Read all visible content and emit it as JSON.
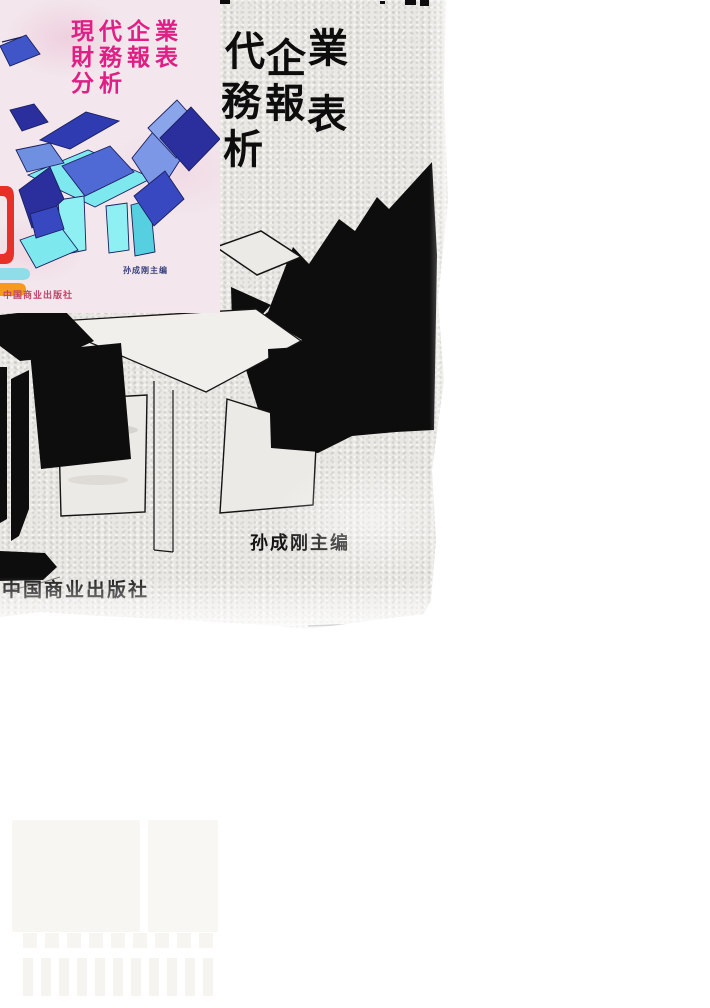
{
  "inset_cover": {
    "title_lines": [
      "現代企業",
      "財務報表",
      "分析"
    ],
    "author": "孙成刚主编",
    "publisher": "中国商业出版社",
    "colors": {
      "background": "#f3e7ed",
      "title_text": "#e01f85",
      "author_text": "#39407e",
      "publisher_text": "#c04468",
      "navy": "#2b2f9e",
      "royal": "#3848c0",
      "light_blue": "#6f8fe0",
      "pale_blue": "#8aa5ea",
      "cyan": "#7de9ee",
      "cyan_deep": "#56cfe0",
      "red": "#e63028",
      "orange": "#f5991f"
    }
  },
  "scan_cover": {
    "title_chars": [
      "代",
      "企",
      "業",
      "務",
      "報",
      "表",
      "析"
    ],
    "author": "孙成刚主编",
    "publisher": "中国商业出版社",
    "colors": {
      "ink": "#0d0d0d",
      "paper": "#e9e8e4"
    }
  }
}
